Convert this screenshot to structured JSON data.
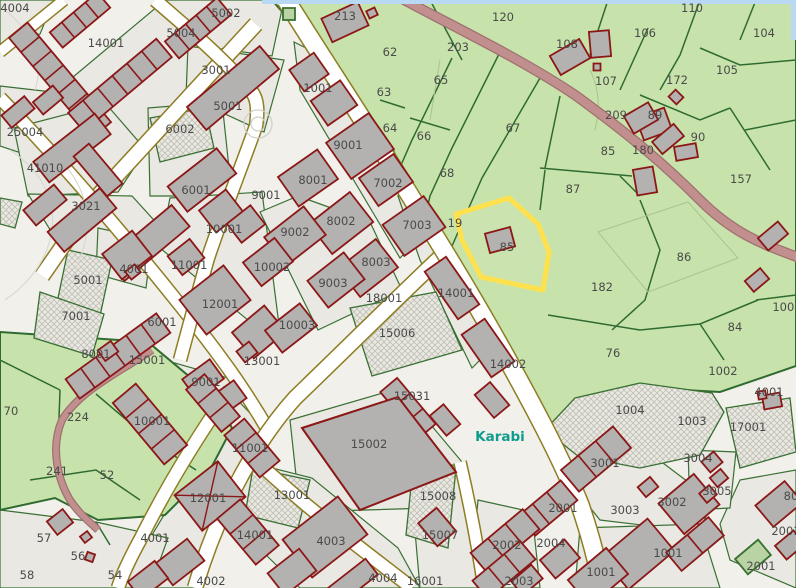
{
  "map": {
    "title": "cadastral-parcel-map",
    "place_labels": [
      {
        "text": "Karabi",
        "x": 500,
        "y": 441
      }
    ],
    "highlight": {
      "parcel_color": "#ffe14d",
      "building_label": "85",
      "adjacent_label": "19"
    },
    "colors": {
      "urban_base": "#f1f0eb",
      "block_fill": "#e9e8e2",
      "parcel_line": "#3a7034",
      "field_green": "#c7e3ab",
      "field_line": "#2f6b31",
      "building_fill": "#b3b2b0",
      "building_line": "#8c1717",
      "street_edge_olive": "#8e7d22",
      "road_mauve": "#c28f8f",
      "road_casing": "#9f7070",
      "water_blue": "#b9d8f3",
      "label_gray": "#4a4a4a",
      "place_teal": "#0f9b8e"
    },
    "parcel_labels": [
      [
        "4004",
        15,
        8
      ],
      [
        "14001",
        106,
        43
      ],
      [
        "5002",
        226,
        13
      ],
      [
        "5004",
        181,
        33
      ],
      [
        "3001",
        216,
        70
      ],
      [
        "5001",
        228,
        106
      ],
      [
        "6002",
        180,
        129
      ],
      [
        "25004",
        25,
        132
      ],
      [
        "41010",
        45,
        168
      ],
      [
        "6001",
        196,
        190
      ],
      [
        "213",
        345,
        16
      ],
      [
        "120",
        503,
        17
      ],
      [
        "62",
        390,
        52
      ],
      [
        "203",
        458,
        47
      ],
      [
        "65",
        441,
        80
      ],
      [
        "63",
        384,
        92
      ],
      [
        "64",
        390,
        128
      ],
      [
        "66",
        424,
        136
      ],
      [
        "67",
        513,
        128
      ],
      [
        "68",
        447,
        173
      ],
      [
        "110",
        692,
        8
      ],
      [
        "106",
        645,
        33
      ],
      [
        "104",
        764,
        33
      ],
      [
        "108",
        567,
        44
      ],
      [
        "107",
        606,
        81
      ],
      [
        "105",
        727,
        70
      ],
      [
        "172",
        677,
        80
      ],
      [
        "209",
        616,
        115
      ],
      [
        "89",
        655,
        115
      ],
      [
        "85",
        608,
        151
      ],
      [
        "90",
        698,
        137
      ],
      [
        "180",
        643,
        150
      ],
      [
        "157",
        741,
        179
      ],
      [
        "87",
        573,
        189
      ],
      [
        "1001",
        318,
        88
      ],
      [
        "9001",
        348,
        145
      ],
      [
        "8001",
        313,
        180
      ],
      [
        "7002",
        388,
        183
      ],
      [
        "3021",
        86,
        206
      ],
      [
        "9001",
        266,
        195
      ],
      [
        "10001",
        224,
        229
      ],
      [
        "11001",
        189,
        265
      ],
      [
        "12001",
        220,
        304
      ],
      [
        "13001",
        262,
        361
      ],
      [
        "4001",
        134,
        269
      ],
      [
        "5001",
        88,
        280
      ],
      [
        "7001",
        76,
        316
      ],
      [
        "6001",
        162,
        322
      ],
      [
        "8001",
        96,
        354
      ],
      [
        "15001",
        147,
        360
      ],
      [
        "9001",
        206,
        382
      ],
      [
        "8002",
        341,
        221
      ],
      [
        "9002",
        295,
        232
      ],
      [
        "10002",
        272,
        267
      ],
      [
        "7003",
        417,
        225
      ],
      [
        "8003",
        376,
        262
      ],
      [
        "9003",
        333,
        283
      ],
      [
        "18001",
        384,
        298
      ],
      [
        "10003",
        297,
        325
      ],
      [
        "15006",
        397,
        333
      ],
      [
        "14001",
        456,
        293
      ],
      [
        "14002",
        508,
        364
      ],
      [
        "19",
        455,
        223
      ],
      [
        "85",
        507,
        247
      ],
      [
        "86",
        684,
        257
      ],
      [
        "182",
        602,
        287
      ],
      [
        "84",
        735,
        327
      ],
      [
        "76",
        613,
        353
      ],
      [
        "1001",
        787,
        307
      ],
      [
        "1002",
        723,
        371
      ],
      [
        "70",
        11,
        411
      ],
      [
        "224",
        78,
        417
      ],
      [
        "52",
        107,
        475
      ],
      [
        "241",
        57,
        471
      ],
      [
        "57",
        44,
        538
      ],
      [
        "56",
        78,
        556
      ],
      [
        "58",
        27,
        575
      ],
      [
        "54",
        115,
        575
      ],
      [
        "10001",
        152,
        421
      ],
      [
        "11001",
        250,
        448
      ],
      [
        "12001",
        208,
        498
      ],
      [
        "14001",
        255,
        535
      ],
      [
        "4001",
        155,
        538
      ],
      [
        "4002",
        211,
        581
      ],
      [
        "15031",
        412,
        396
      ],
      [
        "15002",
        369,
        444
      ],
      [
        "13001",
        292,
        495
      ],
      [
        "15008",
        438,
        496
      ],
      [
        "15007",
        440,
        535
      ],
      [
        "4003",
        331,
        541
      ],
      [
        "4004",
        383,
        578
      ],
      [
        "16001",
        425,
        581
      ],
      [
        "2002",
        507,
        545
      ],
      [
        "2003",
        519,
        581
      ],
      [
        "2004",
        551,
        543
      ],
      [
        "2001",
        563,
        508
      ],
      [
        "1004",
        630,
        410
      ],
      [
        "1003",
        692,
        421
      ],
      [
        "17001",
        748,
        427
      ],
      [
        "3004",
        698,
        458
      ],
      [
        "3001",
        605,
        463
      ],
      [
        "3002",
        672,
        502
      ],
      [
        "3005",
        717,
        491
      ],
      [
        "3003",
        625,
        510
      ],
      [
        "1001",
        668,
        553
      ],
      [
        "1001",
        601,
        572
      ],
      [
        "2001",
        761,
        566
      ],
      [
        "2001",
        786,
        531
      ],
      [
        "80",
        791,
        496
      ],
      [
        "4001",
        769,
        392
      ]
    ]
  }
}
